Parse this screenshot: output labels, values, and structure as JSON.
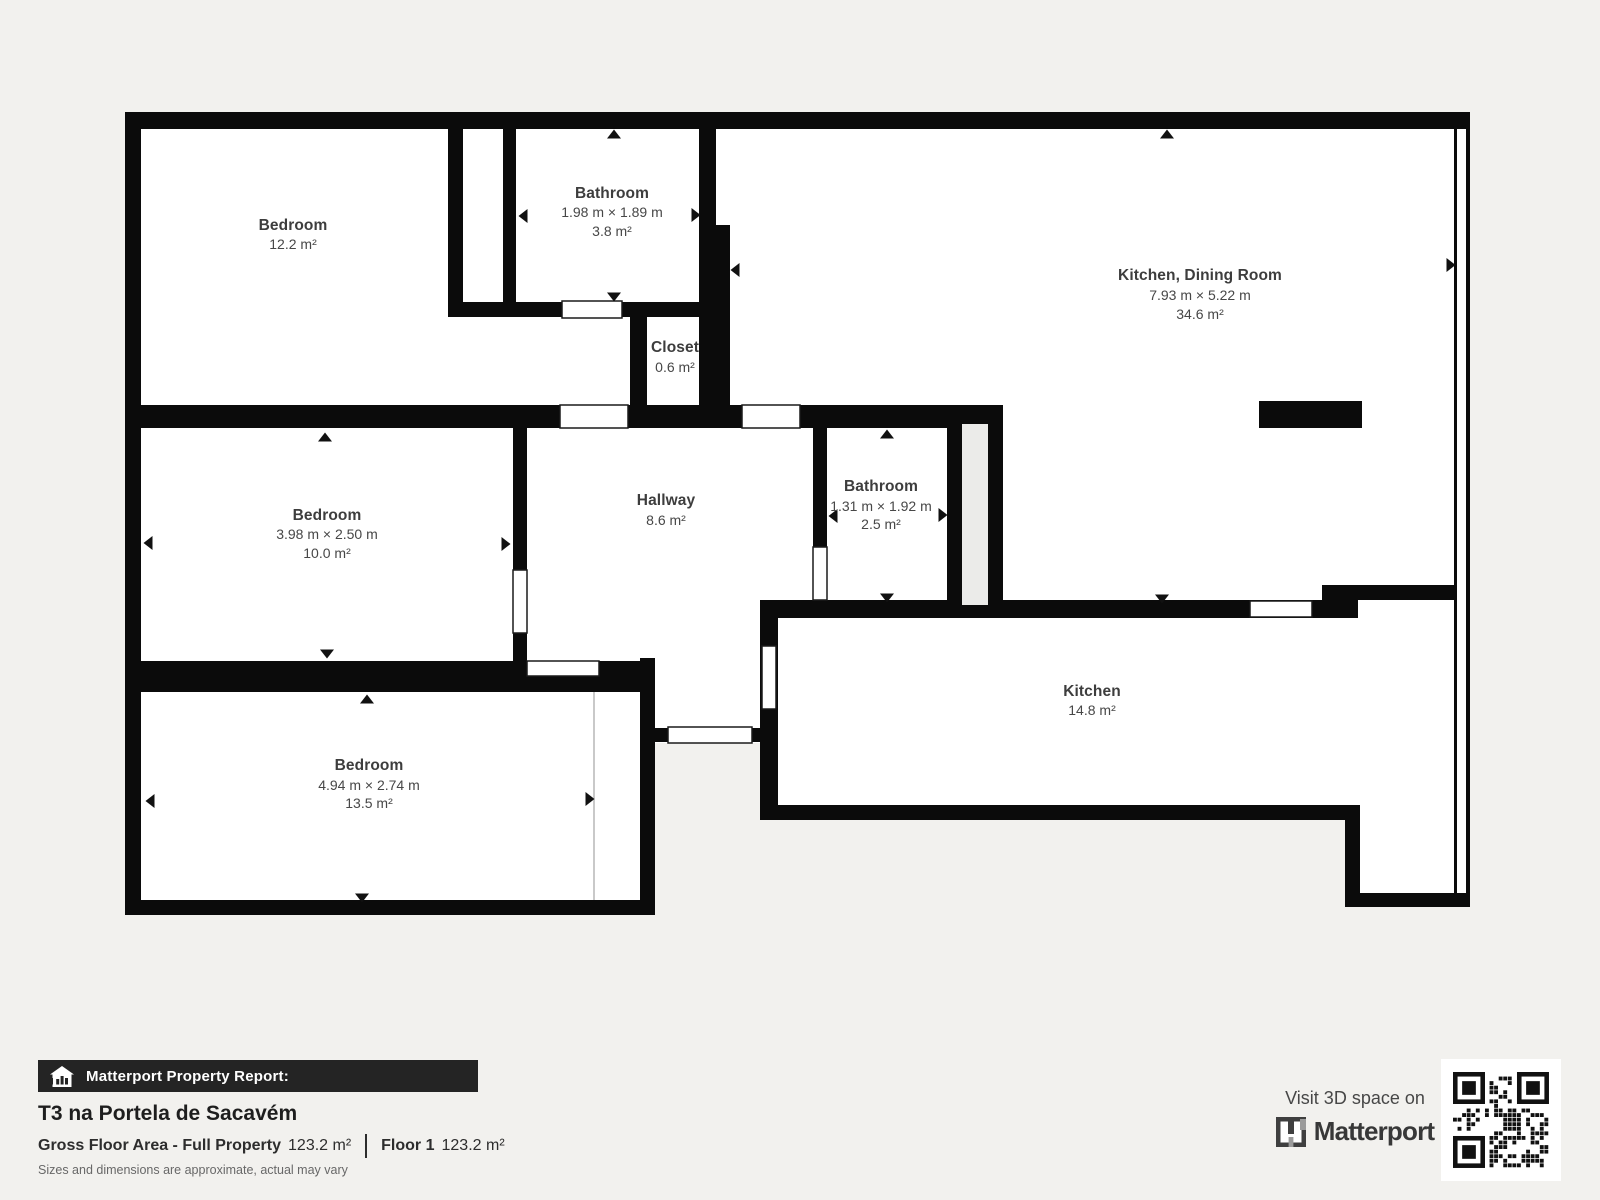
{
  "page": {
    "background": "#f2f1ee"
  },
  "colors": {
    "wall": "#0b0b0b",
    "room_fill": "#ffffff",
    "shaft_fill": "#ebebe9",
    "closet_line": "#c9c9c9",
    "label_text": "#3d3d3d",
    "footer_bar": "#242424",
    "qr_modules": "#111111"
  },
  "rooms": {
    "bedroom1": {
      "name": "Bedroom",
      "area": "12.2 m²"
    },
    "bathroom1": {
      "name": "Bathroom",
      "dims": "1.98 m × 1.89 m",
      "area": "3.8 m²"
    },
    "closet": {
      "name": "Closet",
      "area": "0.6 m²"
    },
    "kitchen_dining": {
      "name": "Kitchen, Dining Room",
      "dims": "7.93 m × 5.22 m",
      "area": "34.6 m²"
    },
    "bedroom2": {
      "name": "Bedroom",
      "dims": "3.98 m × 2.50 m",
      "area": "10.0 m²"
    },
    "hallway": {
      "name": "Hallway",
      "area": "8.6 m²"
    },
    "bathroom2": {
      "name": "Bathroom",
      "dims": "1.31 m × 1.92 m",
      "area": "2.5 m²"
    },
    "bedroom3": {
      "name": "Bedroom",
      "dims": "4.94 m × 2.74 m",
      "area": "13.5 m²"
    },
    "kitchen": {
      "name": "Kitchen",
      "area": "14.8 m²"
    }
  },
  "footer": {
    "report_label": "Matterport Property Report:",
    "property_title": "T3 na Portela de Sacavém",
    "gross_floor_label": "Gross Floor Area - Full Property",
    "gross_floor_value": "123.2 m²",
    "floor_label": "Floor 1",
    "floor_value": "123.2 m²",
    "disclaimer": "Sizes and dimensions are approximate, actual may vary"
  },
  "promo": {
    "visit_text": "Visit 3D space on",
    "brand": "Matterport"
  }
}
